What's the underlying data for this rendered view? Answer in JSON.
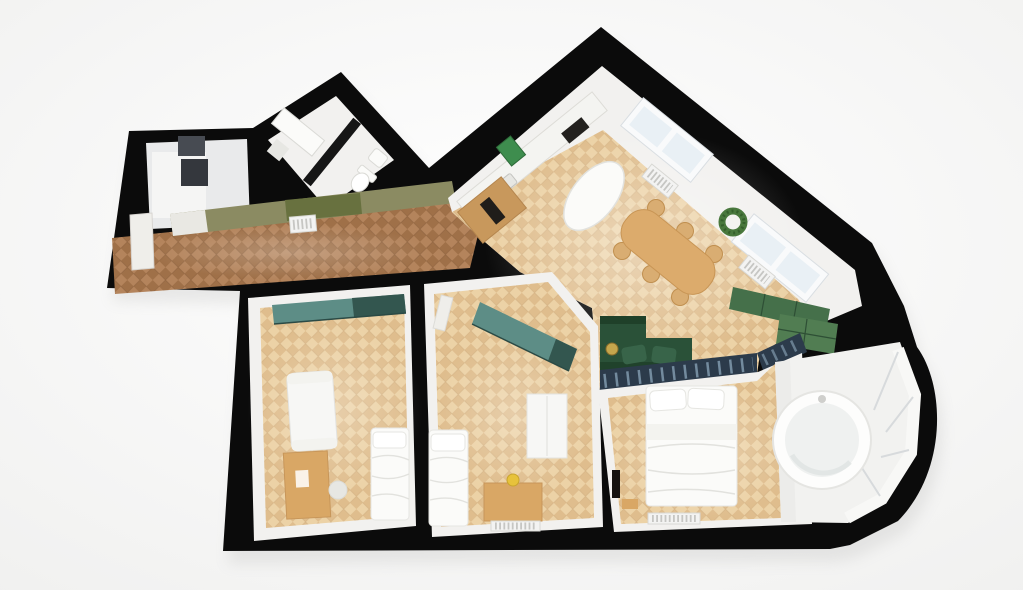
{
  "scene": {
    "type": "apartment-floor-plan-3d-render",
    "rooms": [
      {
        "name": "entry-closet"
      },
      {
        "name": "bathroom"
      },
      {
        "name": "hallway"
      },
      {
        "name": "kitchen-dining"
      },
      {
        "name": "living-area"
      },
      {
        "name": "bedroom-left"
      },
      {
        "name": "bedroom-middle"
      },
      {
        "name": "master-bedroom"
      },
      {
        "name": "bay-window-bath"
      }
    ]
  },
  "colors": {
    "background": "#ffffff",
    "background_edge": "#efefee",
    "wall": "#0b0b0b",
    "shadow": "#9a9a98",
    "room_white": "#f2f1ef",
    "closet_floor": "#e9eaeb",
    "closet_bright": "#f5f5f4",
    "dark_panel": "#474b52",
    "dark_panel2": "#34373d",
    "divider_dark": "#161616",
    "floor_light_a": "#ecd2a6",
    "floor_light_b": "#dfbd8d",
    "floor_light_seam": "#c8a376",
    "floor_dark_a": "#b4845c",
    "floor_dark_b": "#9f7048",
    "floor_dark_seam": "#7e5636",
    "glow_white": "#ffffff",
    "olive": "#8b8b62",
    "olive_dark": "#68713f",
    "olive_white": "#e9e8e3",
    "teal": "#5d8d86",
    "teal_dark": "#33564f",
    "teal_edge": "#2b4a45",
    "door_white": "#efeeea",
    "radiator_white": "#f3f3f2",
    "radiator_line": "#c6c6c3",
    "window_frame": "#f9fafb",
    "window_glass": "#e9f0f5",
    "window_line": "#d9dee2",
    "counter_white": "#f4f4f1",
    "counter_edge": "#dddcd7",
    "cooktop_black": "#23211e",
    "wood_cabinet": "#c8985c",
    "oven_black": "#201d1a",
    "art_green": "#3e8d4e",
    "island_white": "#fbfbf9",
    "island_edge": "#e2e2de",
    "table_wood": "#dcab6c",
    "chair_wood": "#d9ad72",
    "wreath": "#49783d",
    "wreath_dark": "#35602c",
    "cab_green": "#45704a",
    "cab_green2": "#517d52",
    "cab_green_line": "#2e4f35",
    "partition": "#2c3b4b",
    "partition_slat": "#8099ad",
    "sofa": "#2a5138",
    "sofa_light": "#386449",
    "sofa_dark": "#1f4029",
    "tray_gold": "#c5a64d",
    "bed_white": "#fbfbf9",
    "bed_line": "#e6e6e2",
    "pillow_white": "#ffffff",
    "duvet_fold": "#e2e2de",
    "blanket_white": "#f3f3ef",
    "tv_black": "#15120f",
    "desk_wood": "#d9a765",
    "lamp_yellow": "#e7c23b",
    "cabinet_white": "#f7f7f5",
    "cabinet_line": "#e3e3df",
    "fixture_white": "#fbfbf9",
    "fixture_line": "#dadad6",
    "mirror_gray": "#e7e7e3",
    "tub": "#fdfdfc",
    "tub_inner": "#eff1f0",
    "tub_shadow": "#dfe3e2",
    "faucet_gray": "#cfcfcc",
    "bay_floor": "#f2f2f0",
    "bay_frame": "#f8f8f6",
    "bay_frame_line": "#d7dadc",
    "platform": "#ececea"
  }
}
